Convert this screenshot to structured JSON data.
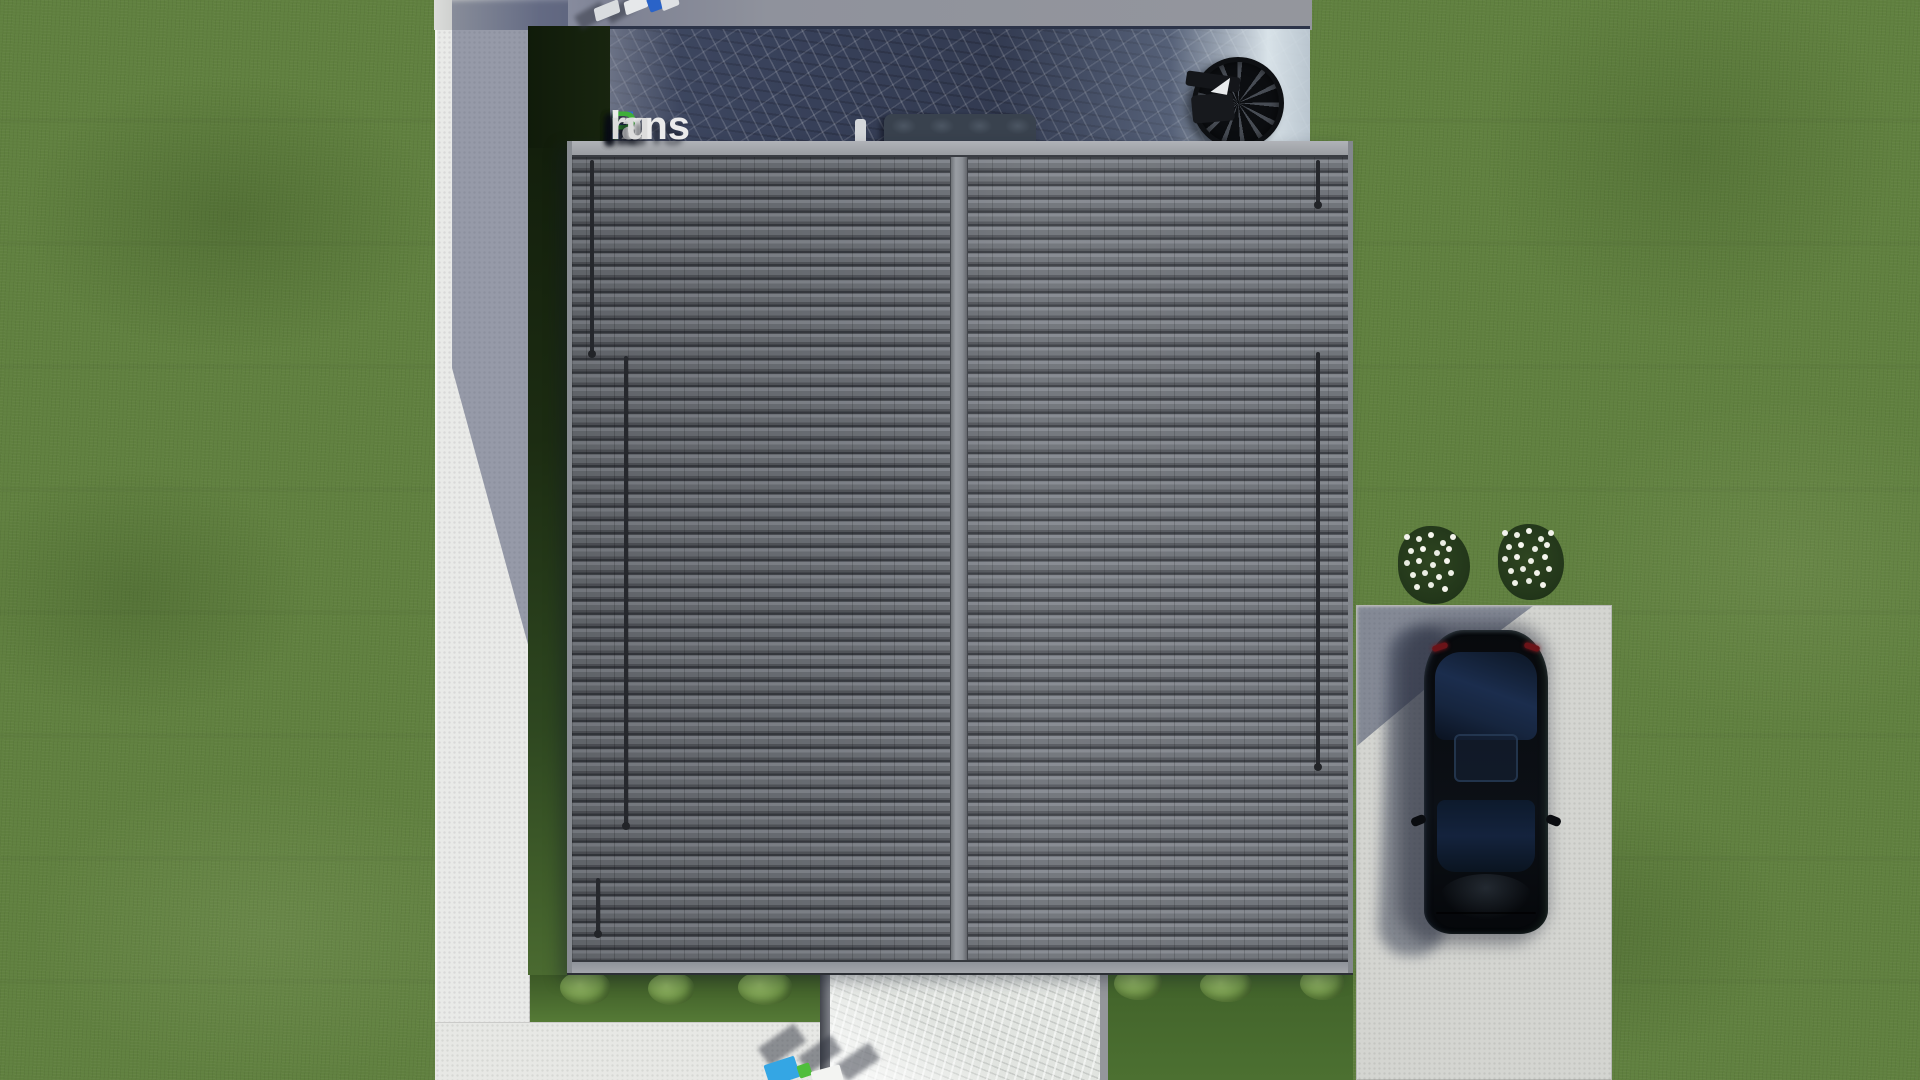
{
  "watermark": {
    "full_text": "FixPlans.ru",
    "segments": [
      {
        "text": "F",
        "color": "#2f6cd6"
      },
      {
        "text": "ix",
        "color": "#ebebeb"
      },
      {
        "text": "P",
        "color": "#3fae3a"
      },
      {
        "text": "lans",
        "color": "#ebebeb"
      },
      {
        "text": ".",
        "color": "#2b64d8"
      },
      {
        "text": "ru",
        "color": "#dcdcdc"
      }
    ]
  },
  "scene": {
    "description": "Aerial top-down 3D architectural rendering of a house plan",
    "objects": [
      "gabled roof with gray tiles and central ridge",
      "dark marble terrace with sofa and spiral staircase",
      "left concrete walkway with building shadow",
      "black car parked on concrete driveway",
      "two white flower bushes beside driveway",
      "green lawn with shrubs",
      "white stone path below house"
    ]
  },
  "palette": {
    "grass": "#60803f",
    "roof_tile": "#6e7278",
    "roof_ridge": "#9a9ea4",
    "terrace_marble": "#38415a",
    "path_concrete": "#e9eae8",
    "shadow_blue": "#303a5a",
    "driveway": "#d4d5d1",
    "car_body": "#0a0d12",
    "taillight_red": "#6b1318",
    "logo_blue": "#2f6cd6",
    "logo_green": "#3fae3a"
  }
}
